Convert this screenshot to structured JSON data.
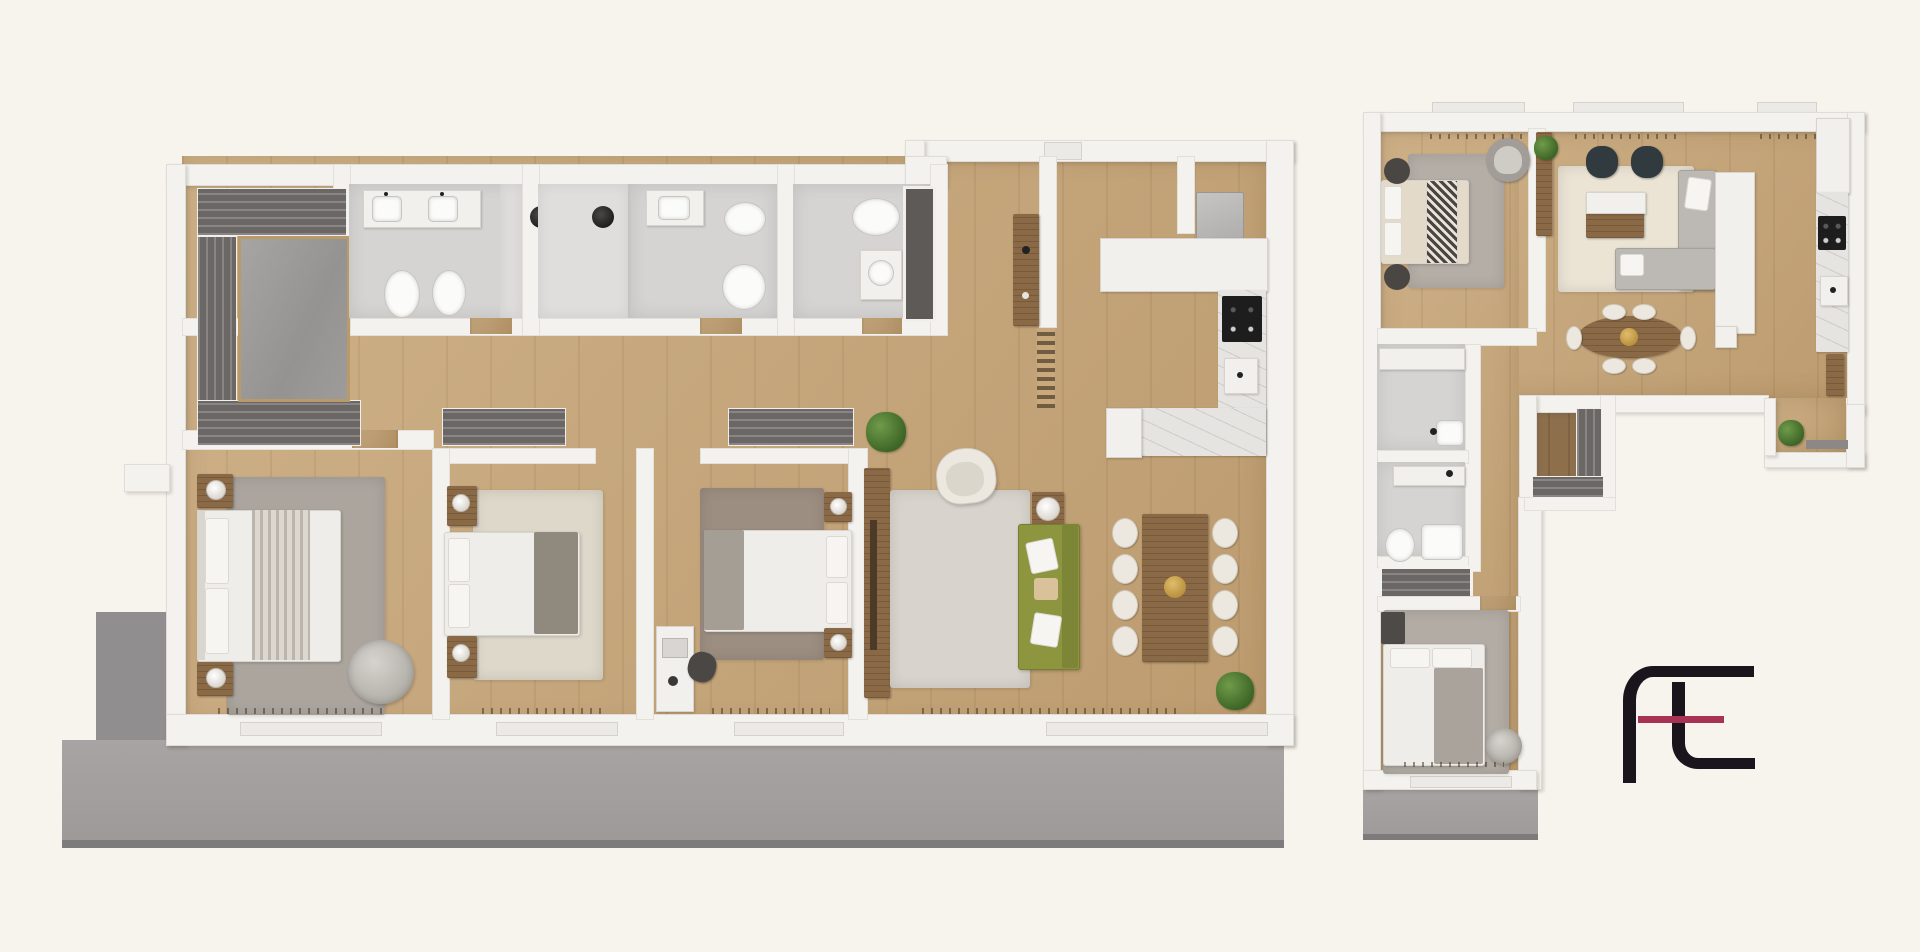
{
  "scene": {
    "kind": "3d-rendered-floor-plan",
    "description": "Top-down 3D render of two apartment floor plans on a cream background with an ft monogram logo",
    "background_color": "#f7f4ee"
  },
  "logo": {
    "monogram": "ft",
    "stroke_color": "#1a151c",
    "accent_color": "#a83254"
  },
  "palette": {
    "wall": "#f4f2ee",
    "wood_floor": "#c9a87b",
    "dark_wood_floor": "#8d6f4c",
    "terrace": "#a3a09f",
    "bath_floor": "#d5d4d2",
    "wardrobe_dark": "#6b6765",
    "walnut_furniture": "#8a6946",
    "marble_counter": "#e6e4e1",
    "olive_sofa": "#8d953f",
    "cream_seat": "#ece8df",
    "dark_armchair": "#313a3e",
    "plant_green": "#4e7a33"
  },
  "plans": {
    "a": {
      "name": "Large apartment - 3 bedrooms, 3 baths, open living/kitchen, full-width terrace",
      "rooms": [
        {
          "name": "Entry foyer with wardrobes and storage room",
          "furniture": [
            "wardrobe strips",
            "storage room"
          ]
        },
        {
          "name": "Bathroom 1",
          "furniture": [
            "double vanity",
            "toilet",
            "bidet",
            "pendant light"
          ]
        },
        {
          "name": "Bathroom 2",
          "furniture": [
            "shower",
            "sink",
            "bidet",
            "toilet",
            "pendant light"
          ]
        },
        {
          "name": "Bathroom 3",
          "furniture": [
            "toilet",
            "sink",
            "dark shower niche"
          ]
        },
        {
          "name": "Entry hall",
          "furniture": [
            "walnut sideboard",
            "ladder radiator"
          ]
        },
        {
          "name": "Utility niche",
          "furniture": [
            "washing machine"
          ]
        },
        {
          "name": "Kitchen",
          "furniture": [
            "white counter",
            "marble counter",
            "cooktop",
            "sink",
            "island"
          ]
        },
        {
          "name": "Master bedroom",
          "furniture": [
            "double bed",
            "2 nightstands with lamps",
            "gray rug",
            "pouf"
          ]
        },
        {
          "name": "Bedroom 2",
          "furniture": [
            "double bed",
            "2 nightstands with lamps",
            "cream rug",
            "wardrobe"
          ]
        },
        {
          "name": "Bedroom 3",
          "furniture": [
            "double bed",
            "2 nightstands with lamps",
            "desk with chair",
            "wardrobe"
          ]
        },
        {
          "name": "Living / dining room",
          "furniture": [
            "tv sideboard",
            "cream armchair",
            "olive green sofa",
            "side table",
            "dining table",
            "8 dining chairs",
            "2 plants",
            "light rug"
          ]
        },
        {
          "name": "Terrace",
          "furniture": []
        }
      ],
      "dining_chairs": 8
    },
    "b": {
      "name": "L-shaped apartment - 2 bedrooms, 2 baths, living/dining/kitchen, balcony and terrace",
      "rooms": [
        {
          "name": "Bedroom 1",
          "furniture": [
            "double bed with patterned runner",
            "2 round poufs",
            "swivel chair",
            "gray rug"
          ]
        },
        {
          "name": "Living room",
          "furniture": [
            "2 dark armchairs",
            "walnut sideboard",
            "L-shaped gray sofa",
            "white partition",
            "cream rug",
            "plant ledge"
          ]
        },
        {
          "name": "Dining area",
          "furniture": [
            "oval walnut table",
            "6 chairs"
          ]
        },
        {
          "name": "Kitchen",
          "furniture": [
            "white counter",
            "marble counter",
            "cooktop",
            "sink"
          ]
        },
        {
          "name": "Bathroom 1",
          "furniture": [
            "vanity",
            "sink"
          ]
        },
        {
          "name": "Bathroom 2",
          "furniture": [
            "vanity",
            "toilet",
            "shower tray"
          ]
        },
        {
          "name": "Walk-in closet",
          "furniture": [
            "L wardrobe"
          ]
        },
        {
          "name": "Bedroom 2",
          "furniture": [
            "double bed",
            "dresser",
            "round chair",
            "gray rug"
          ]
        },
        {
          "name": "Balcony corner",
          "furniture": [
            "plant",
            "bench"
          ]
        },
        {
          "name": "Terrace",
          "furniture": []
        }
      ],
      "dining_chairs": 6
    }
  }
}
